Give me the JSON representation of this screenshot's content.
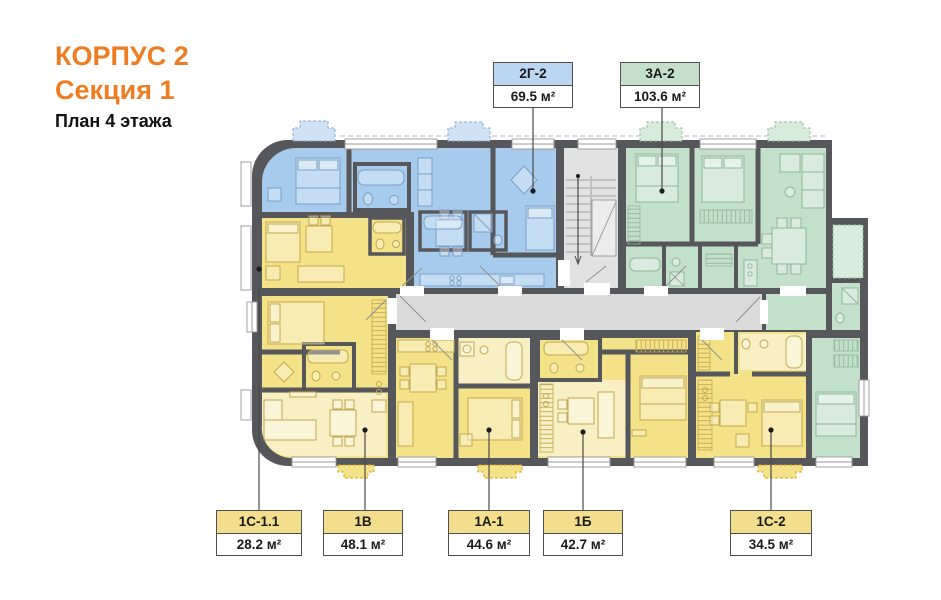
{
  "title": {
    "building": "КОРПУС 2",
    "section": "Секция 1",
    "floor": "План 4 этажа"
  },
  "apartments": [
    {
      "id": "2Г-2",
      "area": "69.5 м²",
      "type": "blue"
    },
    {
      "id": "3А-2",
      "area": "103.6 м²",
      "type": "green"
    },
    {
      "id": "1С-1.1",
      "area": "28.2 м²",
      "type": "yellow"
    },
    {
      "id": "1В",
      "area": "48.1 м²",
      "type": "yellow"
    },
    {
      "id": "1А-1",
      "area": "44.6 м²",
      "type": "yellow"
    },
    {
      "id": "1Б",
      "area": "42.7 м²",
      "type": "yellow"
    },
    {
      "id": "1С-2",
      "area": "34.5 м²",
      "type": "yellow"
    }
  ],
  "colors": {
    "accent": "#ee7d22",
    "wall": "#56575b",
    "blue_unit": "#a7cbec",
    "blue_label": "#bad6f0",
    "green_unit": "#c3e0ca",
    "green_label": "#c4e0cb",
    "yellow_unit": "#f4e289",
    "yellow_pale": "#f8efc4",
    "yellow_label": "#f2de8c",
    "circulation": "#dbdbdb",
    "stair_fill": "#e2e2e2",
    "balcony_outline_yellow": "#d9a21a",
    "fur_blue": "#7d9ec6",
    "fur_green": "#8fb79b",
    "fur_yellow": "#c2a94e"
  }
}
